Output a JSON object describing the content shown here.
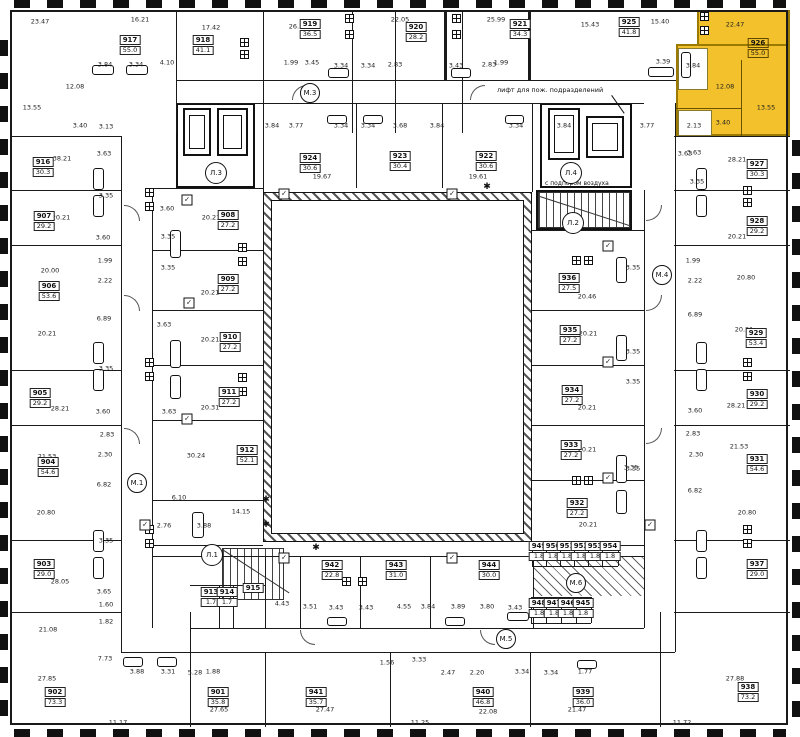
{
  "annotations": {
    "fire_elevator_note": "лифт для пож. подразделений",
    "air_supply_note": "с подпором воздуха"
  },
  "highlight": {
    "unit": "926",
    "color": "#F2C12B"
  },
  "colors": {
    "wall": "#1a1a1a",
    "highlight": "#F2C12B",
    "highlight_border": "#9a7a00"
  },
  "units": [
    {
      "num": "917",
      "area": "55.0",
      "x": 130,
      "y": 45
    },
    {
      "num": "918",
      "area": "41.1",
      "x": 203,
      "y": 45
    },
    {
      "num": "919",
      "area": "36.5",
      "x": 310,
      "y": 29
    },
    {
      "num": "920",
      "area": "28.2",
      "x": 416,
      "y": 32
    },
    {
      "num": "921",
      "area": "34.3",
      "x": 520,
      "y": 29
    },
    {
      "num": "925",
      "area": "41.8",
      "x": 629,
      "y": 27
    },
    {
      "num": "926",
      "area": "55.0",
      "x": 758,
      "y": 48,
      "hl": true
    },
    {
      "num": "916",
      "area": "30.3",
      "x": 43,
      "y": 167
    },
    {
      "num": "907",
      "area": "29.2",
      "x": 44,
      "y": 221
    },
    {
      "num": "906",
      "area": "53.6",
      "x": 49,
      "y": 291
    },
    {
      "num": "905",
      "area": "29.2",
      "x": 40,
      "y": 398
    },
    {
      "num": "904",
      "area": "54.6",
      "x": 48,
      "y": 467
    },
    {
      "num": "903",
      "area": "29.0",
      "x": 44,
      "y": 569
    },
    {
      "num": "902",
      "area": "73.3",
      "x": 55,
      "y": 697
    },
    {
      "num": "927",
      "area": "30.3",
      "x": 757,
      "y": 169
    },
    {
      "num": "928",
      "area": "29.2",
      "x": 757,
      "y": 226
    },
    {
      "num": "929",
      "area": "53.4",
      "x": 756,
      "y": 338
    },
    {
      "num": "930",
      "area": "29.2",
      "x": 757,
      "y": 399
    },
    {
      "num": "931",
      "area": "54.6",
      "x": 757,
      "y": 464
    },
    {
      "num": "937",
      "area": "29.0",
      "x": 757,
      "y": 569
    },
    {
      "num": "938",
      "area": "73.2",
      "x": 748,
      "y": 692
    },
    {
      "num": "908",
      "area": "27.2",
      "x": 228,
      "y": 220
    },
    {
      "num": "909",
      "area": "27.2",
      "x": 228,
      "y": 284
    },
    {
      "num": "910",
      "area": "27.2",
      "x": 230,
      "y": 342
    },
    {
      "num": "911",
      "area": "27.2",
      "x": 229,
      "y": 397
    },
    {
      "num": "912",
      "area": "52.1",
      "x": 247,
      "y": 455
    },
    {
      "num": "924",
      "area": "30.6",
      "x": 310,
      "y": 163
    },
    {
      "num": "923",
      "area": "30.4",
      "x": 400,
      "y": 161
    },
    {
      "num": "922",
      "area": "30.6",
      "x": 486,
      "y": 161
    },
    {
      "num": "936",
      "area": "27.5",
      "x": 569,
      "y": 283
    },
    {
      "num": "935",
      "area": "27.2",
      "x": 570,
      "y": 335
    },
    {
      "num": "934",
      "area": "27.2",
      "x": 572,
      "y": 395
    },
    {
      "num": "933",
      "area": "27.2",
      "x": 571,
      "y": 450
    },
    {
      "num": "932",
      "area": "27.2",
      "x": 577,
      "y": 508
    },
    {
      "num": "913",
      "area": "1.7",
      "x": 211,
      "y": 597
    },
    {
      "num": "914",
      "area": "1.7",
      "x": 227,
      "y": 597
    },
    {
      "num": "915",
      "area": "",
      "x": 253,
      "y": 588
    },
    {
      "num": "942",
      "area": "22.8",
      "x": 332,
      "y": 570
    },
    {
      "num": "943",
      "area": "31.0",
      "x": 396,
      "y": 570
    },
    {
      "num": "944",
      "area": "30.0",
      "x": 489,
      "y": 570
    },
    {
      "num": "901",
      "area": "35.8",
      "x": 218,
      "y": 697
    },
    {
      "num": "941",
      "area": "35.7",
      "x": 316,
      "y": 697
    },
    {
      "num": "940",
      "area": "46.8",
      "x": 483,
      "y": 697
    },
    {
      "num": "939",
      "area": "36.0",
      "x": 583,
      "y": 697
    },
    {
      "num": "948",
      "area": "1.8",
      "x": 539,
      "y": 608
    },
    {
      "num": "947",
      "area": "1.8",
      "x": 554,
      "y": 608
    },
    {
      "num": "946",
      "area": "1.8",
      "x": 568,
      "y": 608
    },
    {
      "num": "945",
      "area": "1.8",
      "x": 583,
      "y": 608
    },
    {
      "num": "949",
      "area": "1.8",
      "x": 539,
      "y": 551
    },
    {
      "num": "950",
      "area": "1.8",
      "x": 553,
      "y": 551
    },
    {
      "num": "951",
      "area": "1.8",
      "x": 567,
      "y": 551
    },
    {
      "num": "952",
      "area": "1.8",
      "x": 581,
      "y": 551
    },
    {
      "num": "953",
      "area": "1.8",
      "x": 595,
      "y": 551
    },
    {
      "num": "954",
      "area": "1.8",
      "x": 610,
      "y": 551
    }
  ],
  "room_areas": [
    {
      "v": "23.47",
      "x": 40,
      "y": 22
    },
    {
      "v": "16.21",
      "x": 140,
      "y": 20
    },
    {
      "v": "17.42",
      "x": 211,
      "y": 28
    },
    {
      "v": "4.10",
      "x": 167,
      "y": 63
    },
    {
      "v": "3.84",
      "x": 105,
      "y": 65
    },
    {
      "v": "3.34",
      "x": 136,
      "y": 65
    },
    {
      "v": "12.08",
      "x": 75,
      "y": 87
    },
    {
      "v": "13.55",
      "x": 32,
      "y": 108
    },
    {
      "v": "3.40",
      "x": 80,
      "y": 126
    },
    {
      "v": "3.13",
      "x": 106,
      "y": 127
    },
    {
      "v": "3.63",
      "x": 104,
      "y": 154
    },
    {
      "v": "38.21",
      "x": 62,
      "y": 159
    },
    {
      "v": "26.72",
      "x": 298,
      "y": 27
    },
    {
      "v": "22.05",
      "x": 400,
      "y": 20
    },
    {
      "v": "25.99",
      "x": 496,
      "y": 20
    },
    {
      "v": "1.99",
      "x": 291,
      "y": 63
    },
    {
      "v": "3.45",
      "x": 312,
      "y": 63
    },
    {
      "v": "3.34",
      "x": 341,
      "y": 66
    },
    {
      "v": "3.34",
      "x": 368,
      "y": 66
    },
    {
      "v": "2.83",
      "x": 395,
      "y": 65
    },
    {
      "v": "3.43",
      "x": 456,
      "y": 66
    },
    {
      "v": "2.83",
      "x": 489,
      "y": 65
    },
    {
      "v": "1.99",
      "x": 501,
      "y": 63
    },
    {
      "v": "15.43",
      "x": 590,
      "y": 25
    },
    {
      "v": "15.40",
      "x": 660,
      "y": 22
    },
    {
      "v": "22.47",
      "x": 735,
      "y": 25
    },
    {
      "v": "3.39",
      "x": 663,
      "y": 62
    },
    {
      "v": "3.84",
      "x": 693,
      "y": 66
    },
    {
      "v": "12.08",
      "x": 725,
      "y": 87
    },
    {
      "v": "13.55",
      "x": 766,
      "y": 108
    },
    {
      "v": "3.40",
      "x": 723,
      "y": 123
    },
    {
      "v": "2.13",
      "x": 694,
      "y": 126
    },
    {
      "v": "3.63",
      "x": 685,
      "y": 154
    },
    {
      "v": "28.21",
      "x": 737,
      "y": 160
    },
    {
      "v": "3.84",
      "x": 272,
      "y": 126
    },
    {
      "v": "3.77",
      "x": 296,
      "y": 126
    },
    {
      "v": "3.34",
      "x": 341,
      "y": 126
    },
    {
      "v": "3.34",
      "x": 368,
      "y": 126
    },
    {
      "v": "3.68",
      "x": 400,
      "y": 126
    },
    {
      "v": "3.84",
      "x": 437,
      "y": 126
    },
    {
      "v": "3.34",
      "x": 516,
      "y": 126
    },
    {
      "v": "3.84",
      "x": 564,
      "y": 126
    },
    {
      "v": "3.77",
      "x": 647,
      "y": 126
    },
    {
      "v": "19.67",
      "x": 322,
      "y": 177
    },
    {
      "v": "19.61",
      "x": 478,
      "y": 177
    },
    {
      "v": "20.21",
      "x": 61,
      "y": 218
    },
    {
      "v": "3.60",
      "x": 103,
      "y": 238
    },
    {
      "v": "1.99",
      "x": 105,
      "y": 261
    },
    {
      "v": "2.22",
      "x": 105,
      "y": 281
    },
    {
      "v": "20.00",
      "x": 50,
      "y": 271
    },
    {
      "v": "6.89",
      "x": 104,
      "y": 319
    },
    {
      "v": "20.21",
      "x": 47,
      "y": 334
    },
    {
      "v": "3.35",
      "x": 106,
      "y": 196
    },
    {
      "v": "28.21",
      "x": 60,
      "y": 409
    },
    {
      "v": "3.60",
      "x": 103,
      "y": 412
    },
    {
      "v": "2.83",
      "x": 107,
      "y": 435
    },
    {
      "v": "2.30",
      "x": 105,
      "y": 455
    },
    {
      "v": "21.53",
      "x": 47,
      "y": 457
    },
    {
      "v": "6.82",
      "x": 104,
      "y": 485
    },
    {
      "v": "20.80",
      "x": 46,
      "y": 513
    },
    {
      "v": "3.35",
      "x": 106,
      "y": 369
    },
    {
      "v": "3.35",
      "x": 106,
      "y": 541
    },
    {
      "v": "28.05",
      "x": 60,
      "y": 582
    },
    {
      "v": "3.65",
      "x": 104,
      "y": 592
    },
    {
      "v": "1.60",
      "x": 106,
      "y": 605
    },
    {
      "v": "1.82",
      "x": 106,
      "y": 622
    },
    {
      "v": "21.08",
      "x": 48,
      "y": 630
    },
    {
      "v": "7.73",
      "x": 105,
      "y": 659
    },
    {
      "v": "27.85",
      "x": 47,
      "y": 679
    },
    {
      "v": "11.17",
      "x": 118,
      "y": 723
    },
    {
      "v": "3.88",
      "x": 137,
      "y": 672
    },
    {
      "v": "3.31",
      "x": 168,
      "y": 672
    },
    {
      "v": "5.28",
      "x": 195,
      "y": 673
    },
    {
      "v": "1.88",
      "x": 213,
      "y": 672
    },
    {
      "v": "3.63",
      "x": 694,
      "y": 153
    },
    {
      "v": "3.35",
      "x": 697,
      "y": 182
    },
    {
      "v": "20.21",
      "x": 737,
      "y": 237
    },
    {
      "v": "1.99",
      "x": 693,
      "y": 261
    },
    {
      "v": "2.22",
      "x": 695,
      "y": 281
    },
    {
      "v": "20.80",
      "x": 746,
      "y": 278
    },
    {
      "v": "6.89",
      "x": 695,
      "y": 315
    },
    {
      "v": "20.21",
      "x": 744,
      "y": 330
    },
    {
      "v": "3.35",
      "x": 633,
      "y": 352
    },
    {
      "v": "3.35",
      "x": 633,
      "y": 382
    },
    {
      "v": "28.21",
      "x": 736,
      "y": 406
    },
    {
      "v": "3.60",
      "x": 695,
      "y": 411
    },
    {
      "v": "2.83",
      "x": 693,
      "y": 434
    },
    {
      "v": "21.53",
      "x": 739,
      "y": 447
    },
    {
      "v": "2.30",
      "x": 696,
      "y": 455
    },
    {
      "v": "6.82",
      "x": 695,
      "y": 491
    },
    {
      "v": "20.80",
      "x": 747,
      "y": 513
    },
    {
      "v": "3.35",
      "x": 633,
      "y": 469
    },
    {
      "v": "27.88",
      "x": 735,
      "y": 679
    },
    {
      "v": "11.72",
      "x": 682,
      "y": 723
    },
    {
      "v": "3.60",
      "x": 167,
      "y": 209
    },
    {
      "v": "20.21",
      "x": 211,
      "y": 218
    },
    {
      "v": "3.35",
      "x": 168,
      "y": 237
    },
    {
      "v": "3.35",
      "x": 168,
      "y": 268
    },
    {
      "v": "20.21",
      "x": 210,
      "y": 293
    },
    {
      "v": "3.63",
      "x": 164,
      "y": 325
    },
    {
      "v": "20.21",
      "x": 210,
      "y": 340
    },
    {
      "v": "20.31",
      "x": 210,
      "y": 408
    },
    {
      "v": "3.63",
      "x": 169,
      "y": 412
    },
    {
      "v": "30.24",
      "x": 196,
      "y": 456
    },
    {
      "v": "6.10",
      "x": 179,
      "y": 498
    },
    {
      "v": "14.15",
      "x": 241,
      "y": 512
    },
    {
      "v": "2.76",
      "x": 164,
      "y": 526
    },
    {
      "v": "3.88",
      "x": 204,
      "y": 526
    },
    {
      "v": "20.46",
      "x": 587,
      "y": 297
    },
    {
      "v": "20.21",
      "x": 588,
      "y": 334
    },
    {
      "v": "3.35",
      "x": 633,
      "y": 268
    },
    {
      "v": "20.21",
      "x": 587,
      "y": 408
    },
    {
      "v": "20.21",
      "x": 587,
      "y": 450
    },
    {
      "v": "20.21",
      "x": 588,
      "y": 525
    },
    {
      "v": "3.35",
      "x": 631,
      "y": 468
    },
    {
      "v": "4.43",
      "x": 282,
      "y": 604
    },
    {
      "v": "3.51",
      "x": 310,
      "y": 607
    },
    {
      "v": "3.43",
      "x": 336,
      "y": 608
    },
    {
      "v": "3.43",
      "x": 366,
      "y": 608
    },
    {
      "v": "4.55",
      "x": 404,
      "y": 607
    },
    {
      "v": "3.84",
      "x": 428,
      "y": 607
    },
    {
      "v": "3.89",
      "x": 458,
      "y": 607
    },
    {
      "v": "3.80",
      "x": 487,
      "y": 607
    },
    {
      "v": "3.43",
      "x": 515,
      "y": 608
    },
    {
      "v": "27.65",
      "x": 219,
      "y": 710
    },
    {
      "v": "27.47",
      "x": 325,
      "y": 710
    },
    {
      "v": "1.56",
      "x": 387,
      "y": 663
    },
    {
      "v": "3.33",
      "x": 419,
      "y": 660
    },
    {
      "v": "2.47",
      "x": 448,
      "y": 673
    },
    {
      "v": "2.20",
      "x": 477,
      "y": 673
    },
    {
      "v": "3.34",
      "x": 522,
      "y": 672
    },
    {
      "v": "3.34",
      "x": 551,
      "y": 673
    },
    {
      "v": "1.77",
      "x": 585,
      "y": 672
    },
    {
      "v": "22.08",
      "x": 488,
      "y": 712
    },
    {
      "v": "11.25",
      "x": 420,
      "y": 723
    },
    {
      "v": "21.47",
      "x": 577,
      "y": 710
    }
  ],
  "m_marks": [
    {
      "label": "М.1",
      "x": 137,
      "y": 483
    },
    {
      "label": "М.3",
      "x": 310,
      "y": 93
    },
    {
      "label": "М.4",
      "x": 662,
      "y": 275
    },
    {
      "label": "М.5",
      "x": 506,
      "y": 639
    },
    {
      "label": "М.6",
      "x": 576,
      "y": 583
    }
  ],
  "stair_marks": [
    {
      "label": "Л.1",
      "x": 212,
      "y": 555
    },
    {
      "label": "Л.2",
      "x": 573,
      "y": 223
    },
    {
      "label": "Л.3",
      "x": 216,
      "y": 173
    },
    {
      "label": "Л.4",
      "x": 571,
      "y": 173
    }
  ],
  "check_positions": [
    [
      187,
      200
    ],
    [
      189,
      303
    ],
    [
      187,
      419
    ],
    [
      608,
      246
    ],
    [
      608,
      362
    ],
    [
      608,
      478
    ],
    [
      284,
      194
    ],
    [
      452,
      194
    ],
    [
      284,
      558
    ],
    [
      452,
      558
    ],
    [
      145,
      525
    ],
    [
      650,
      525
    ]
  ],
  "asterisk_positions": [
    [
      266,
      500
    ],
    [
      266,
      525
    ],
    [
      316,
      548
    ],
    [
      487,
      187
    ]
  ]
}
